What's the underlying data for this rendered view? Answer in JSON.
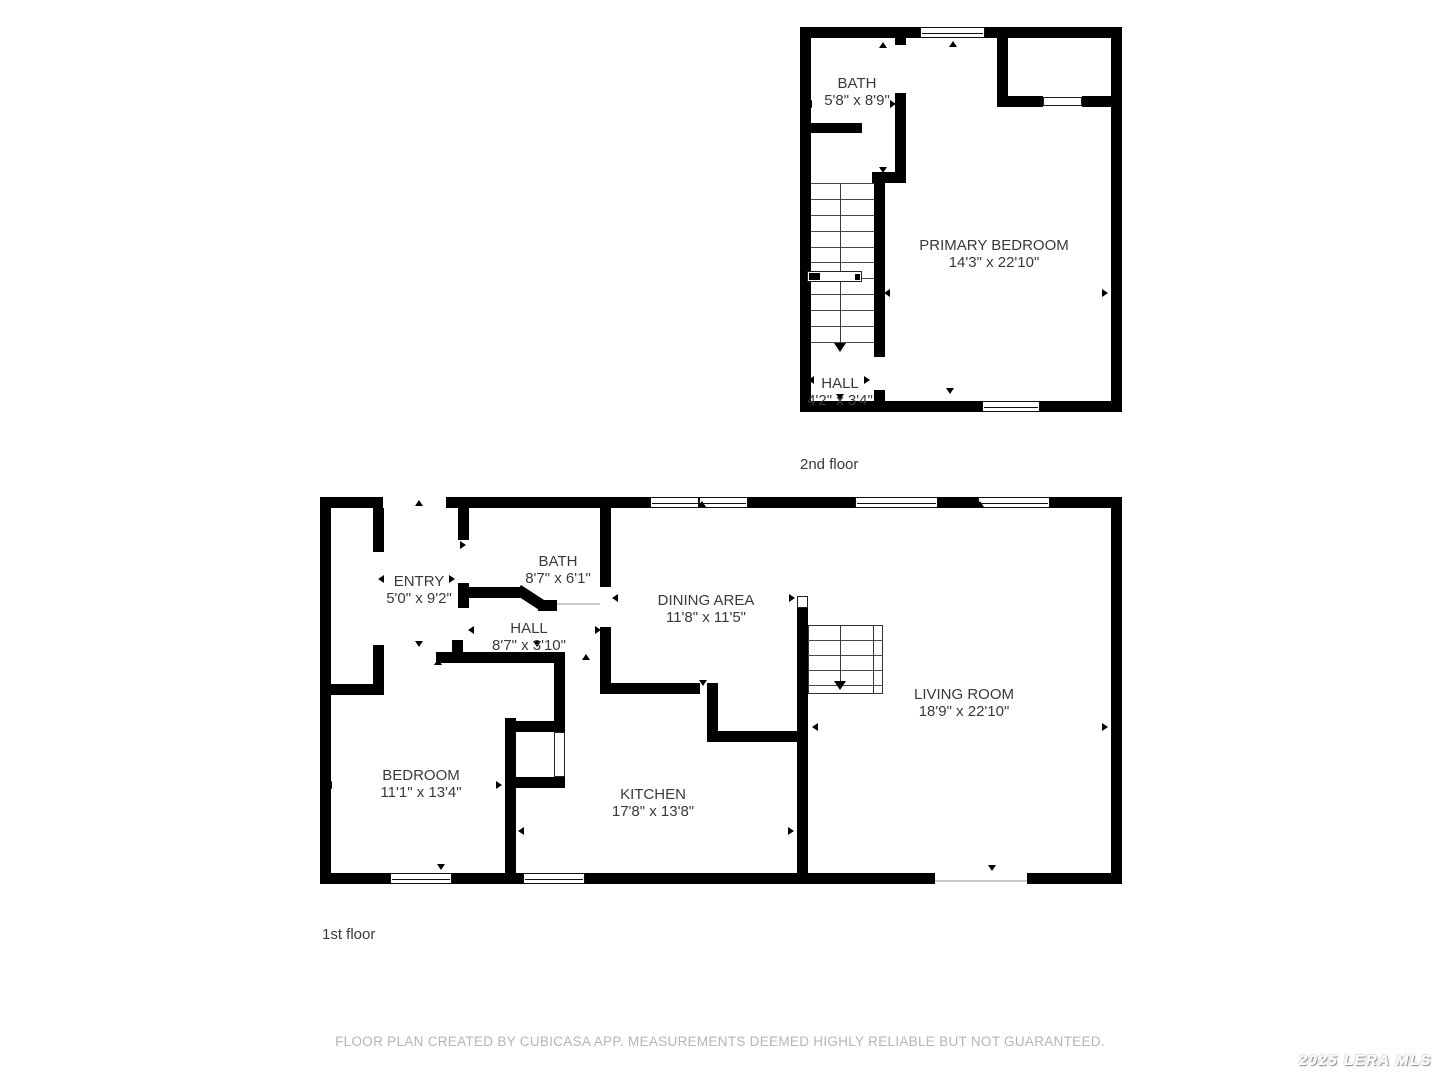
{
  "footer": {
    "text": "FLOOR PLAN CREATED BY CUBICASA APP. MEASUREMENTS DEEMED HIGHLY RELIABLE BUT NOT GUARANTEED."
  },
  "watermark": {
    "text": "2025 LERA MLS"
  },
  "colors": {
    "wall": "#000000",
    "label": "#3a3a3a",
    "footer": "#b5b5b5"
  },
  "floors": [
    {
      "caption": "2nd floor",
      "caption_x": 800,
      "caption_y": 456,
      "rooms": [
        {
          "name": "BATH",
          "dims": "5'8\" x 8'9\"",
          "x": 857,
          "y": 75
        },
        {
          "name": "PRIMARY BEDROOM",
          "dims": "14'3\" x 22'10\"",
          "x": 994,
          "y": 237
        },
        {
          "name": "HALL",
          "dims": "4'2\" x 3'4\"",
          "x": 840,
          "y": 375
        }
      ],
      "walls": [
        [
          800,
          27,
          120,
          11
        ],
        [
          985,
          27,
          137,
          11
        ],
        [
          800,
          38,
          11,
          363
        ],
        [
          1111,
          38,
          11,
          363
        ],
        [
          800,
          401,
          182,
          11
        ],
        [
          1040,
          401,
          82,
          11
        ],
        [
          895,
          38,
          11,
          7
        ],
        [
          895,
          93,
          11,
          84
        ],
        [
          811,
          123,
          51,
          10
        ],
        [
          872,
          172,
          34,
          11
        ],
        [
          874,
          183,
          11,
          174
        ],
        [
          874,
          390,
          11,
          11
        ],
        [
          997,
          38,
          11,
          67
        ],
        [
          997,
          96,
          46,
          11
        ],
        [
          1082,
          96,
          29,
          11
        ]
      ],
      "diagonals": [],
      "windows": [
        [
          920,
          27,
          65,
          11
        ],
        [
          982,
          401,
          58,
          11
        ]
      ],
      "door_panels": [
        [
          1043,
          97,
          39,
          9
        ]
      ],
      "thin_lines": [],
      "stairs": {
        "x": 811,
        "w": 63,
        "tread_ys": [
          183,
          199,
          215,
          231,
          247,
          262,
          278,
          294,
          310,
          326,
          342
        ],
        "center_x": 840,
        "c1": 184,
        "c2": 344,
        "arrow_y": 352,
        "landing": [
          807,
          271,
          55,
          11
        ]
      },
      "arrows": [
        [
          883,
          42,
          "up"
        ],
        [
          953,
          41,
          "up"
        ],
        [
          806,
          104,
          "left"
        ],
        [
          896,
          104,
          "right"
        ],
        [
          883,
          173,
          "down"
        ],
        [
          884,
          293,
          "left"
        ],
        [
          1108,
          293,
          "right"
        ],
        [
          950,
          394,
          "down"
        ],
        [
          808,
          380,
          "left"
        ],
        [
          870,
          380,
          "right"
        ],
        [
          840,
          400,
          "down"
        ]
      ]
    },
    {
      "caption": "1st floor",
      "caption_x": 322,
      "caption_y": 926,
      "rooms": [
        {
          "name": "ENTRY",
          "dims": "5'0\" x 9'2\"",
          "x": 419,
          "y": 573
        },
        {
          "name": "BATH",
          "dims": "8'7\" x 6'1\"",
          "x": 558,
          "y": 553
        },
        {
          "name": "HALL",
          "dims": "8'7\" x 3'10\"",
          "x": 529,
          "y": 620
        },
        {
          "name": "DINING AREA",
          "dims": "11'8\" x 11'5\"",
          "x": 706,
          "y": 592
        },
        {
          "name": "LIVING ROOM",
          "dims": "18'9\" x 22'10\"",
          "x": 964,
          "y": 686
        },
        {
          "name": "BEDROOM",
          "dims": "11'1\" x 13'4\"",
          "x": 421,
          "y": 767
        },
        {
          "name": "KITCHEN",
          "dims": "17'8\" x 13'8\"",
          "x": 653,
          "y": 786
        }
      ],
      "walls": [
        [
          320,
          497,
          63,
          11
        ],
        [
          446,
          497,
          204,
          11
        ],
        [
          748,
          497,
          107,
          11
        ],
        [
          938,
          497,
          40,
          11
        ],
        [
          1050,
          497,
          72,
          11
        ],
        [
          320,
          508,
          11,
          365
        ],
        [
          1111,
          508,
          11,
          365
        ],
        [
          320,
          873,
          70,
          11
        ],
        [
          452,
          873,
          71,
          11
        ],
        [
          585,
          873,
          350,
          11
        ],
        [
          1027,
          873,
          95,
          11
        ],
        [
          373,
          508,
          11,
          44
        ],
        [
          373,
          645,
          11,
          50
        ],
        [
          326,
          684,
          47,
          11
        ],
        [
          436,
          652,
          129,
          11
        ],
        [
          452,
          640,
          11,
          12
        ],
        [
          458,
          508,
          11,
          32
        ],
        [
          458,
          583,
          11,
          25
        ],
        [
          458,
          587,
          65,
          11
        ],
        [
          538,
          600,
          19,
          11
        ],
        [
          600,
          508,
          11,
          79
        ],
        [
          600,
          627,
          11,
          67
        ],
        [
          600,
          683,
          100,
          11
        ],
        [
          707,
          683,
          11,
          59
        ],
        [
          707,
          731,
          90,
          11
        ],
        [
          797,
          608,
          11,
          265
        ],
        [
          505,
          718,
          11,
          155
        ],
        [
          554,
          652,
          11,
          80
        ],
        [
          505,
          721,
          60,
          11
        ],
        [
          505,
          777,
          60,
          11
        ],
        [
          554,
          777,
          11,
          11
        ]
      ],
      "diagonals": [
        [
          521,
          585,
          30,
          11,
          33
        ]
      ],
      "windows": [
        [
          650,
          497,
          98,
          11,
          "m"
        ],
        [
          855,
          497,
          83,
          11
        ],
        [
          978,
          497,
          72,
          11
        ],
        [
          390,
          873,
          62,
          11
        ],
        [
          523,
          873,
          62,
          11
        ]
      ],
      "door_panels": [
        [
          797,
          596,
          11,
          12
        ],
        [
          554,
          732,
          11,
          45
        ]
      ],
      "thin_lines": [
        [
          557,
          603,
          43,
          2
        ],
        [
          935,
          880,
          92,
          2
        ]
      ],
      "stairs": {
        "x": 808,
        "w": 75,
        "tread_ys": [
          640,
          655,
          670,
          685
        ],
        "border": [
          808,
          625,
          75,
          69
        ],
        "rail_x": 873,
        "center_x": 840,
        "c1": 626,
        "c2": 682,
        "arrow_y": 690
      },
      "arrows": [
        [
          419,
          500,
          "up"
        ],
        [
          702,
          501,
          "up"
        ],
        [
          980,
          501,
          "up"
        ],
        [
          378,
          579,
          "left"
        ],
        [
          455,
          579,
          "right"
        ],
        [
          419,
          647,
          "down"
        ],
        [
          466,
          545,
          "right"
        ],
        [
          468,
          630,
          "left"
        ],
        [
          601,
          630,
          "right"
        ],
        [
          537,
          647,
          "down"
        ],
        [
          586,
          654,
          "up"
        ],
        [
          612,
          598,
          "left"
        ],
        [
          795,
          598,
          "right"
        ],
        [
          703,
          686,
          "down"
        ],
        [
          326,
          785,
          "left"
        ],
        [
          502,
          785,
          "right"
        ],
        [
          438,
          659,
          "up"
        ],
        [
          441,
          870,
          "down"
        ],
        [
          518,
          831,
          "left"
        ],
        [
          794,
          831,
          "right"
        ],
        [
          812,
          727,
          "left"
        ],
        [
          1108,
          727,
          "right"
        ],
        [
          992,
          871,
          "down"
        ]
      ]
    }
  ]
}
